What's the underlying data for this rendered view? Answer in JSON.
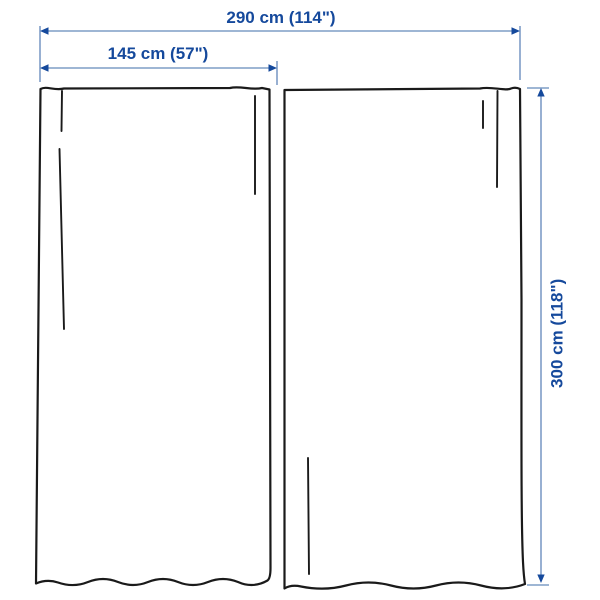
{
  "diagram": {
    "type": "product-dimension-diagram",
    "subject": "pair of curtain panels",
    "dimensions": {
      "total_width": {
        "label": "290 cm (114\")",
        "orientation": "horizontal"
      },
      "panel_width": {
        "label": "145 cm (57\")",
        "orientation": "horizontal"
      },
      "height": {
        "label": "300 cm (118\")",
        "orientation": "vertical"
      }
    }
  },
  "colors": {
    "dimension_text": "#15499c",
    "dimension_line": "#7f9dc6",
    "curtain_outline": "#1a1a1a",
    "background": "#ffffff"
  }
}
